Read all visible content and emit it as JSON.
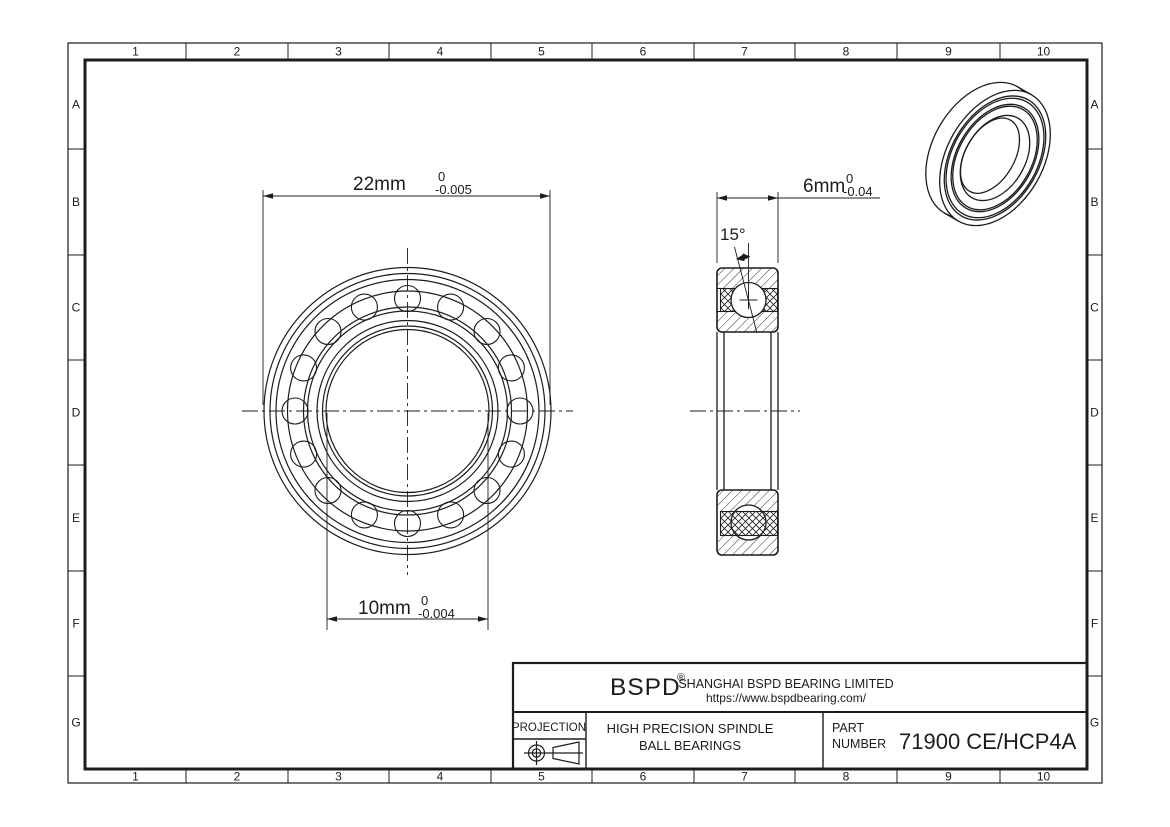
{
  "grid": {
    "columns": [
      "1",
      "2",
      "3",
      "4",
      "5",
      "6",
      "7",
      "8",
      "9",
      "10"
    ],
    "rows": [
      "A",
      "B",
      "C",
      "D",
      "E",
      "F",
      "G"
    ]
  },
  "dimensions": {
    "outer_diameter": {
      "value": "22mm",
      "tol_upper": "0",
      "tol_lower": "-0.005"
    },
    "bore_diameter": {
      "value": "10mm",
      "tol_upper": "0",
      "tol_lower": "-0.004"
    },
    "width": {
      "value": "6mm",
      "tol_upper": "0",
      "tol_lower": "-0.04"
    },
    "contact_angle": "15°"
  },
  "title_block": {
    "brand": "BSPD",
    "reg_mark": "®",
    "company": "SHANGHAI BSPD BEARING LIMITED",
    "website": "https://www.bspdbearing.com/",
    "projection_label": "PROJECTION",
    "product_line1": "HIGH  PRECISION SPINDLE",
    "product_line2": "BALL BEARINGS",
    "part_label_line1": "PART",
    "part_label_line2": "NUMBER",
    "part_number": "71900 CE/HCP4A"
  },
  "colors": {
    "line": "#1c1c1c",
    "background": "#ffffff"
  }
}
